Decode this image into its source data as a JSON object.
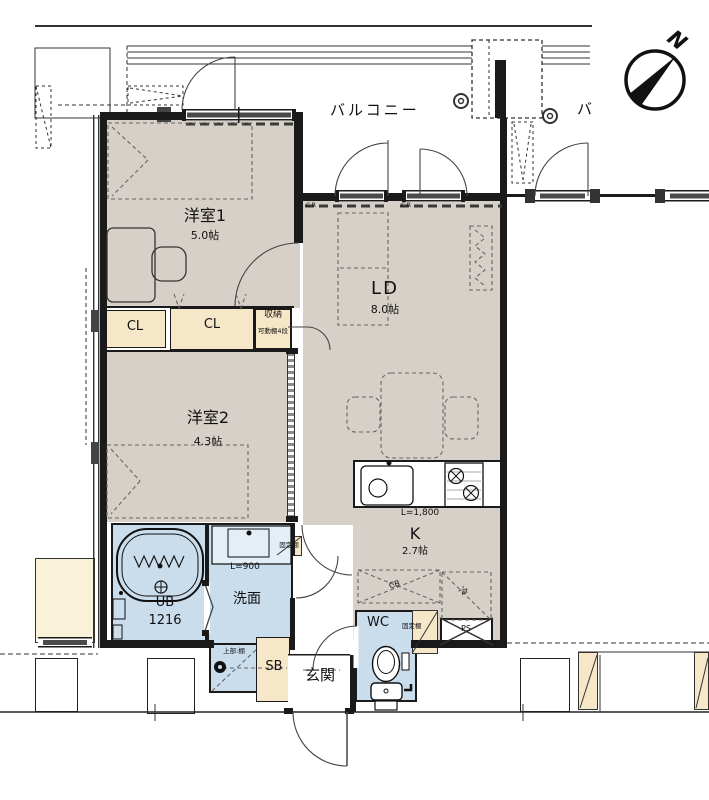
{
  "compass": {
    "north": "N"
  },
  "balcony": {
    "main": "バルコニー",
    "neighbor": "バ"
  },
  "rooms": {
    "bedroom1": {
      "name": "洋室1",
      "size": "5.0帖"
    },
    "bedroom2": {
      "name": "洋室2",
      "size": "4.3帖"
    },
    "living_dining": {
      "name": "LD",
      "size": "8.0帖"
    },
    "kitchen": {
      "name": "K",
      "size": "2.7帖",
      "counter_length": "L=1,800"
    },
    "unit_bath": {
      "name": "UB",
      "size": "1216"
    },
    "washroom": {
      "name": "洗面",
      "counter_length": "L=900",
      "upper_shelf": "上部:棚"
    },
    "toilet": {
      "name": "WC",
      "fixed_shelf": "固定棚"
    },
    "entrance": {
      "name": "玄関"
    },
    "shoe_box": {
      "name": "SB"
    }
  },
  "storage": {
    "closet1": "CL",
    "closet2": "CL",
    "shuno": {
      "name": "収納",
      "note": "可動棚4段"
    },
    "hall_fixed_shelf": "固定棚"
  },
  "marks": {
    "curtain_rail_left": "CR",
    "curtain_rail_right": "CR",
    "cupboard": "CB",
    "refrigerator": "冷",
    "pipe_space": "PS"
  },
  "colors": {
    "wall": "#1a1a1a",
    "floor": "#d7d0c8",
    "closet": "#f7e7c9",
    "wet_area": "#cadded",
    "neighbor_floor": "#faf2d8"
  }
}
